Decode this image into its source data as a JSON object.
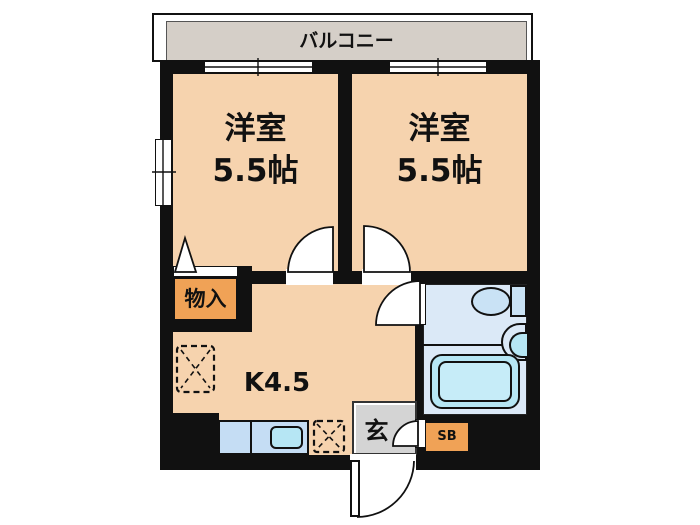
{
  "floorplan": {
    "balcony": {
      "label": "バルコニー"
    },
    "room_left": {
      "name": "洋室",
      "size": "5.5帖"
    },
    "room_right": {
      "name": "洋室",
      "size": "5.5帖"
    },
    "storage": {
      "label": "物入"
    },
    "kitchen": {
      "label": "K4.5"
    },
    "entrance": {
      "label": "玄"
    },
    "shoe_box": {
      "label": "SB"
    },
    "colors": {
      "room_fill": "#f6d3ae",
      "storage_fill": "#f0a256",
      "balcony_fill": "#d5cfc8",
      "entrance_fill": "#d4d4d4",
      "bathroom_fill": "#dbe9f7",
      "fixture_fill": "#b6e6f4",
      "counter_fill": "#c5ddf4",
      "wall": "#111111"
    }
  }
}
